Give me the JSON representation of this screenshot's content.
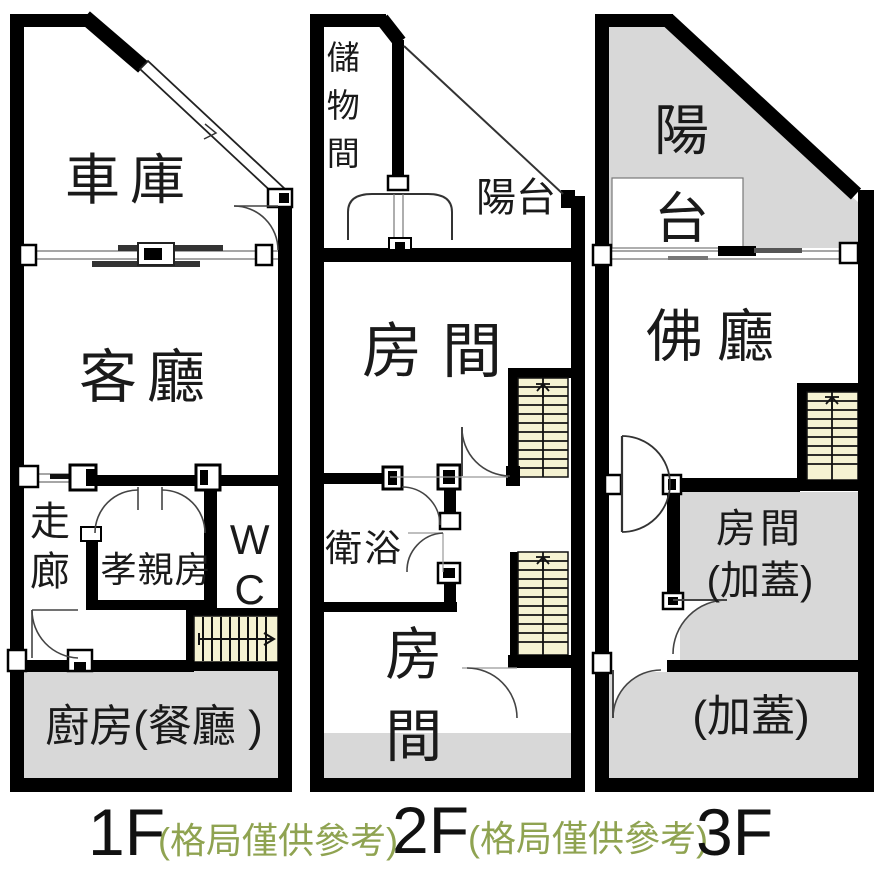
{
  "figure": {
    "kind": "real-estate floor plan, 3 storeys side by side",
    "floors": [
      {
        "caption": "1F",
        "note": "(格局僅供參考)",
        "rooms": {
          "garage": "車庫",
          "living": "客廳",
          "corridor": "走廊",
          "parents": "孝親房",
          "wc": "WC",
          "kitchen": "廚房(餐廳 )"
        }
      },
      {
        "caption": "2F",
        "note": "(格局僅供參考)",
        "rooms": {
          "storage": "儲物間",
          "balcony": "陽台",
          "front_room": "房間",
          "bath": "衛浴",
          "back_room": "房間"
        }
      },
      {
        "caption": "3F",
        "rooms": {
          "balcony": "陽台",
          "hall": "佛廳",
          "room": "房間",
          "room_suffix": "(加蓋)",
          "annex": "(加蓋)"
        }
      }
    ],
    "colors": {
      "wall": "#000000",
      "stair_fill": "#f5f2d2",
      "area_fill": "#d8d8d8",
      "note_green": "#8fa351",
      "thin_line": "#555555"
    }
  }
}
